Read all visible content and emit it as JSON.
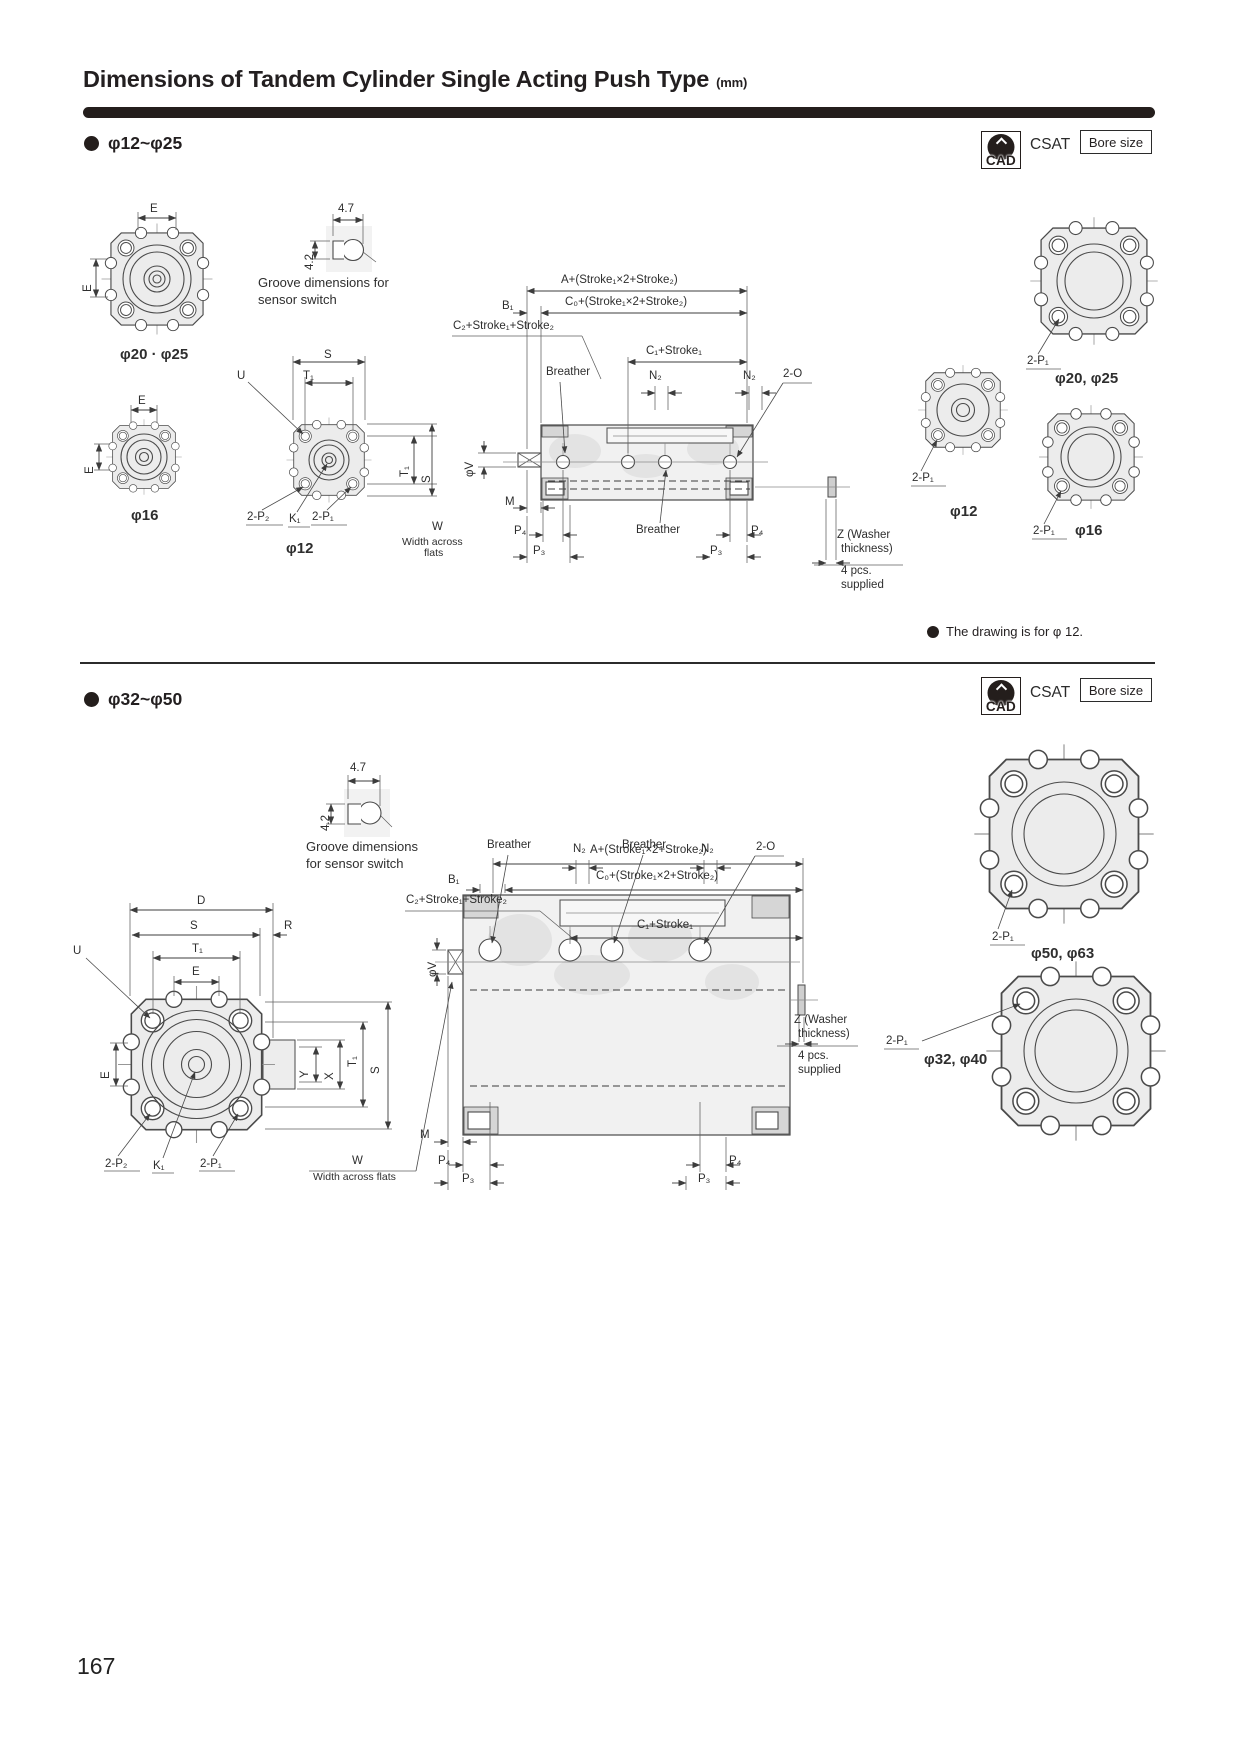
{
  "page": {
    "title": "Dimensions of Tandem Cylinder Single Acting Push Type",
    "title_unit": "(mm)",
    "note1": "The drawing is for φ 12.",
    "page_number": "167"
  },
  "badges": {
    "cad_label": "CAD",
    "series": "CSAT",
    "bore_size": "Bore size"
  },
  "section1": {
    "header": "φ12~φ25",
    "labels": [
      {
        "t": "E",
        "x": 150,
        "y": 203
      },
      {
        "t": "E",
        "x": 82,
        "y": 292,
        "r": 1
      },
      {
        "t": "φ20 · φ25",
        "x": 120,
        "y": 347,
        "b": 1
      },
      {
        "t": "4.7",
        "x": 338,
        "y": 203
      },
      {
        "t": "4.2",
        "x": 304,
        "y": 270,
        "r": 1
      },
      {
        "t": "Groove dimensions for",
        "x": 258,
        "y": 276,
        "s": 13
      },
      {
        "t": "sensor switch",
        "x": 258,
        "y": 293,
        "s": 13
      },
      {
        "t": "E",
        "x": 138,
        "y": 395
      },
      {
        "t": "E",
        "x": 84,
        "y": 474,
        "r": 1
      },
      {
        "t": "φ16",
        "x": 131,
        "y": 508,
        "b": 1
      },
      {
        "t": "S",
        "x": 324,
        "y": 349
      },
      {
        "t": "T₁",
        "x": 303,
        "y": 370
      },
      {
        "t": "U",
        "x": 237,
        "y": 370
      },
      {
        "t": "T₁",
        "x": 399,
        "y": 477,
        "r": 1
      },
      {
        "t": "S",
        "x": 421,
        "y": 483,
        "r": 1
      },
      {
        "t": "2-P₂",
        "x": 247,
        "y": 511
      },
      {
        "t": "K₁",
        "x": 289,
        "y": 513
      },
      {
        "t": "2-P₁",
        "x": 312,
        "y": 511
      },
      {
        "t": "φ12",
        "x": 286,
        "y": 541,
        "b": 1
      },
      {
        "t": "W",
        "x": 432,
        "y": 521
      },
      {
        "t": "Width across",
        "x": 402,
        "y": 537,
        "s": 10.5
      },
      {
        "t": "flats",
        "x": 424,
        "y": 548,
        "s": 10.5
      },
      {
        "t": "A+(Stroke₁×2+Stroke₂)",
        "x": 561,
        "y": 274
      },
      {
        "t": "C₀+(Stroke₁×2+Stroke₂)",
        "x": 565,
        "y": 296
      },
      {
        "t": "B₁",
        "x": 502,
        "y": 300
      },
      {
        "t": "C₂+Stroke₁+Stroke₂",
        "x": 453,
        "y": 320
      },
      {
        "t": "C₁+Stroke₁",
        "x": 646,
        "y": 345
      },
      {
        "t": "Breather",
        "x": 546,
        "y": 366
      },
      {
        "t": "N₂",
        "x": 649,
        "y": 370
      },
      {
        "t": "N₂",
        "x": 743,
        "y": 370
      },
      {
        "t": "2-O",
        "x": 783,
        "y": 368
      },
      {
        "t": "φV",
        "x": 464,
        "y": 477,
        "r": 1
      },
      {
        "t": "M",
        "x": 505,
        "y": 496
      },
      {
        "t": "P₄",
        "x": 514,
        "y": 525
      },
      {
        "t": "P₃",
        "x": 533,
        "y": 545
      },
      {
        "t": "Breather",
        "x": 636,
        "y": 524
      },
      {
        "t": "P₄",
        "x": 751,
        "y": 525
      },
      {
        "t": "P₃",
        "x": 710,
        "y": 545
      },
      {
        "t": "Z (Washer",
        "x": 837,
        "y": 529
      },
      {
        "t": "thickness)",
        "x": 841,
        "y": 543
      },
      {
        "t": "4 pcs.",
        "x": 841,
        "y": 565
      },
      {
        "t": "supplied",
        "x": 841,
        "y": 579
      },
      {
        "t": "2-P₁",
        "x": 1027,
        "y": 355
      },
      {
        "t": "φ20, φ25",
        "x": 1055,
        "y": 371,
        "b": 1
      },
      {
        "t": "2-P₁",
        "x": 912,
        "y": 472
      },
      {
        "t": "φ12",
        "x": 950,
        "y": 504,
        "b": 1
      },
      {
        "t": "2-P₁",
        "x": 1033,
        "y": 525
      },
      {
        "t": "φ16",
        "x": 1075,
        "y": 523,
        "b": 1
      }
    ]
  },
  "section2": {
    "header": "φ32~φ50",
    "labels": [
      {
        "t": "4.7",
        "x": 350,
        "y": 762
      },
      {
        "t": "4.2",
        "x": 320,
        "y": 831,
        "r": 1
      },
      {
        "t": "Groove dimensions",
        "x": 306,
        "y": 840,
        "s": 13
      },
      {
        "t": "for sensor switch",
        "x": 306,
        "y": 857,
        "s": 13
      },
      {
        "t": "D",
        "x": 197,
        "y": 895
      },
      {
        "t": "S",
        "x": 190,
        "y": 920
      },
      {
        "t": "R",
        "x": 284,
        "y": 920
      },
      {
        "t": "T₁",
        "x": 192,
        "y": 943
      },
      {
        "t": "E",
        "x": 192,
        "y": 966
      },
      {
        "t": "U",
        "x": 73,
        "y": 945
      },
      {
        "t": "E",
        "x": 100,
        "y": 1079,
        "r": 1
      },
      {
        "t": "Y",
        "x": 299,
        "y": 1078,
        "r": 1
      },
      {
        "t": "X",
        "x": 324,
        "y": 1080,
        "r": 1
      },
      {
        "t": "T₁",
        "x": 347,
        "y": 1067,
        "r": 1
      },
      {
        "t": "S",
        "x": 370,
        "y": 1074,
        "r": 1
      },
      {
        "t": "2-P₂",
        "x": 105,
        "y": 1158
      },
      {
        "t": "K₁",
        "x": 153,
        "y": 1160
      },
      {
        "t": "2-P₁",
        "x": 200,
        "y": 1158
      },
      {
        "t": "W",
        "x": 352,
        "y": 1155
      },
      {
        "t": "Width across flats",
        "x": 313,
        "y": 1172,
        "s": 10.5
      },
      {
        "t": "A+(Stroke₁×2+Stroke₂)",
        "x": 590,
        "y": 844
      },
      {
        "t": "C₀+(Stroke₁×2+Stroke₂)",
        "x": 596,
        "y": 870
      },
      {
        "t": "B₁",
        "x": 448,
        "y": 874
      },
      {
        "t": "C₂+Stroke₁+Stroke₂",
        "x": 406,
        "y": 894
      },
      {
        "t": "C₁+Stroke₁",
        "x": 637,
        "y": 919
      },
      {
        "t": "Breather",
        "x": 487,
        "y": 839
      },
      {
        "t": "N₂",
        "x": 573,
        "y": 843
      },
      {
        "t": "Breather",
        "x": 622,
        "y": 839
      },
      {
        "t": "N₂",
        "x": 701,
        "y": 843
      },
      {
        "t": "2-O",
        "x": 756,
        "y": 841
      },
      {
        "t": "φV",
        "x": 427,
        "y": 977,
        "r": 1
      },
      {
        "t": "M",
        "x": 420,
        "y": 1129
      },
      {
        "t": "P₄",
        "x": 438,
        "y": 1155
      },
      {
        "t": "P₃",
        "x": 462,
        "y": 1173
      },
      {
        "t": "P₄",
        "x": 729,
        "y": 1155
      },
      {
        "t": "P₃",
        "x": 698,
        "y": 1173
      },
      {
        "t": "Z (Washer",
        "x": 794,
        "y": 1014
      },
      {
        "t": "thickness)",
        "x": 798,
        "y": 1028
      },
      {
        "t": "4 pcs.",
        "x": 798,
        "y": 1050
      },
      {
        "t": "supplied",
        "x": 798,
        "y": 1064
      },
      {
        "t": "2-P₁",
        "x": 886,
        "y": 1035
      },
      {
        "t": "φ32, φ40",
        "x": 924,
        "y": 1052,
        "b": 1
      },
      {
        "t": "2-P₁",
        "x": 992,
        "y": 931
      },
      {
        "t": "φ50, φ63",
        "x": 1031,
        "y": 946,
        "b": 1
      }
    ]
  }
}
